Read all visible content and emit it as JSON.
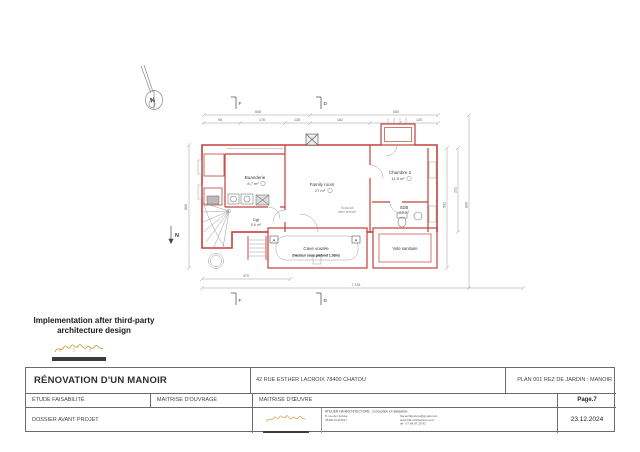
{
  "note": {
    "line1": "Implementation after third-party",
    "line2": "architecture design"
  },
  "plan": {
    "compass_n": "N",
    "north_label": "N",
    "section_markers": {
      "f": "F",
      "d": "D"
    },
    "cut_marker": "A",
    "rooms": {
      "buanderie": {
        "name": "Buanderie",
        "area": "8.7 m²"
      },
      "family": {
        "name": "Family room",
        "area": "27 m²",
        "note1": "Sous-sol",
        "note2": "semi enterré"
      },
      "chambre2": {
        "name": "Chambre 2",
        "area": "11.8 m²"
      },
      "sdb": {
        "name": "SDB",
        "area": "3.5 m²"
      },
      "dgt": {
        "name": "Dgt",
        "area": "5.6 m²"
      },
      "cave": {
        "name": "Cave voutée",
        "note": "(hauteur sous plafond 1.93m)"
      },
      "vide": {
        "name": "Vide sanitaire"
      }
    },
    "dims": {
      "top_left": "608",
      "top_right": "650",
      "left": "860",
      "right_a": "592",
      "right_b": "231",
      "right_c": "860",
      "bottom_short": "470",
      "bottom_long": "7.134",
      "segs": [
        "95",
        "178",
        "128",
        "162",
        "120"
      ]
    }
  },
  "titleblock": {
    "project": "RÉNOVATION D'UN MANOIR",
    "address": "42 RUE ESTHER LACROIX 78400 CHATOU",
    "plan_ref": "PLAN 001 REZ DE JARDIN : MANOIR",
    "etude": "ÉTUDE FAISABILITÉ",
    "maitrise_ouvrage": "MAITRISE D'OUVRAGE",
    "maitrise_oeuvre": "MAITRISE D'ŒUVRE",
    "page": "Page.7",
    "phase": "DOSSIER AVANT PROJET",
    "date": "23.12.2024",
    "firm": {
      "line1": "ATELIER HA ARCHITECTURE : conception et réalisation",
      "addr1": "8, rue de l'écluse",
      "addr2": "78400 CHATOU",
      "contact1": "hla.architecture@gmail.com",
      "contact2": "www.hla-architecture.com",
      "contact3": "tél : 07 68 87 29 92"
    }
  },
  "colors": {
    "wall": "#c4403a",
    "gold": "#c8a44b"
  }
}
